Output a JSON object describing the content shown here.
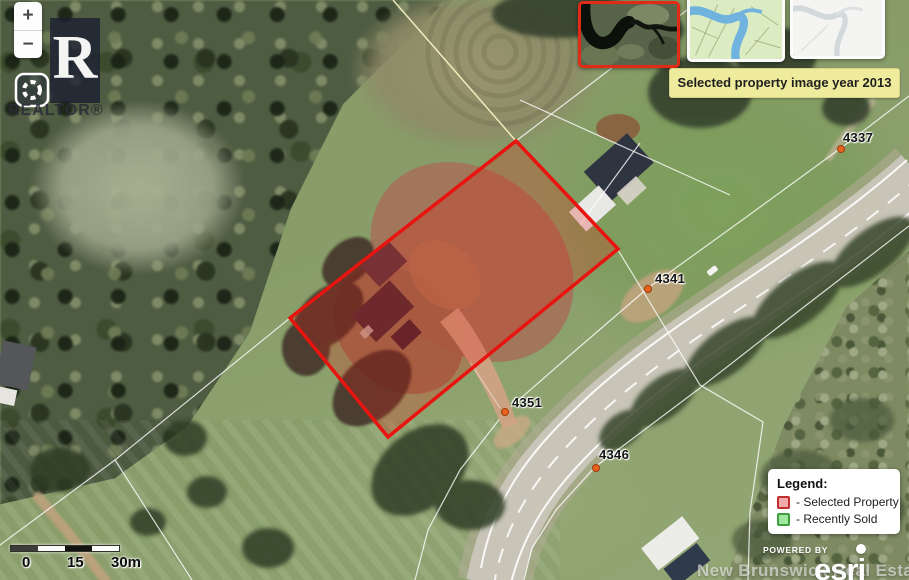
{
  "map": {
    "tooltip": "Selected property image year 2013",
    "markers": [
      {
        "label": "4337"
      },
      {
        "label": "4341"
      },
      {
        "label": "4351"
      },
      {
        "label": "4346"
      }
    ],
    "marker_dot_color": "#e8641e",
    "selected_property_outline_color": "#e81410",
    "thumbnails": [
      {
        "name": "aerial-imagery-2013-thumbnail",
        "selected": true
      },
      {
        "name": "topographic-map-thumbnail",
        "selected": false
      },
      {
        "name": "light-basemap-thumbnail",
        "selected": false
      }
    ]
  },
  "controls": {
    "zoom_in": "+",
    "zoom_out": "−"
  },
  "branding": {
    "realtor_logo_letter": "R",
    "realtor_logo_text": "REALTOR®",
    "powered_by": "POWERED BY",
    "powered_by_brand": "esri",
    "watermark": "New Brunswick Real Estate Board"
  },
  "legend": {
    "title": "Legend:",
    "items": [
      {
        "label": "- Selected Property",
        "swatch_fill": "#f2a9a9",
        "swatch_border": "#c03030"
      },
      {
        "label": "- Recently Sold",
        "swatch_fill": "#9fe89f",
        "swatch_border": "#3f9f3f"
      }
    ]
  },
  "scale_bar": {
    "labels": [
      "0",
      "15",
      "30m"
    ]
  }
}
